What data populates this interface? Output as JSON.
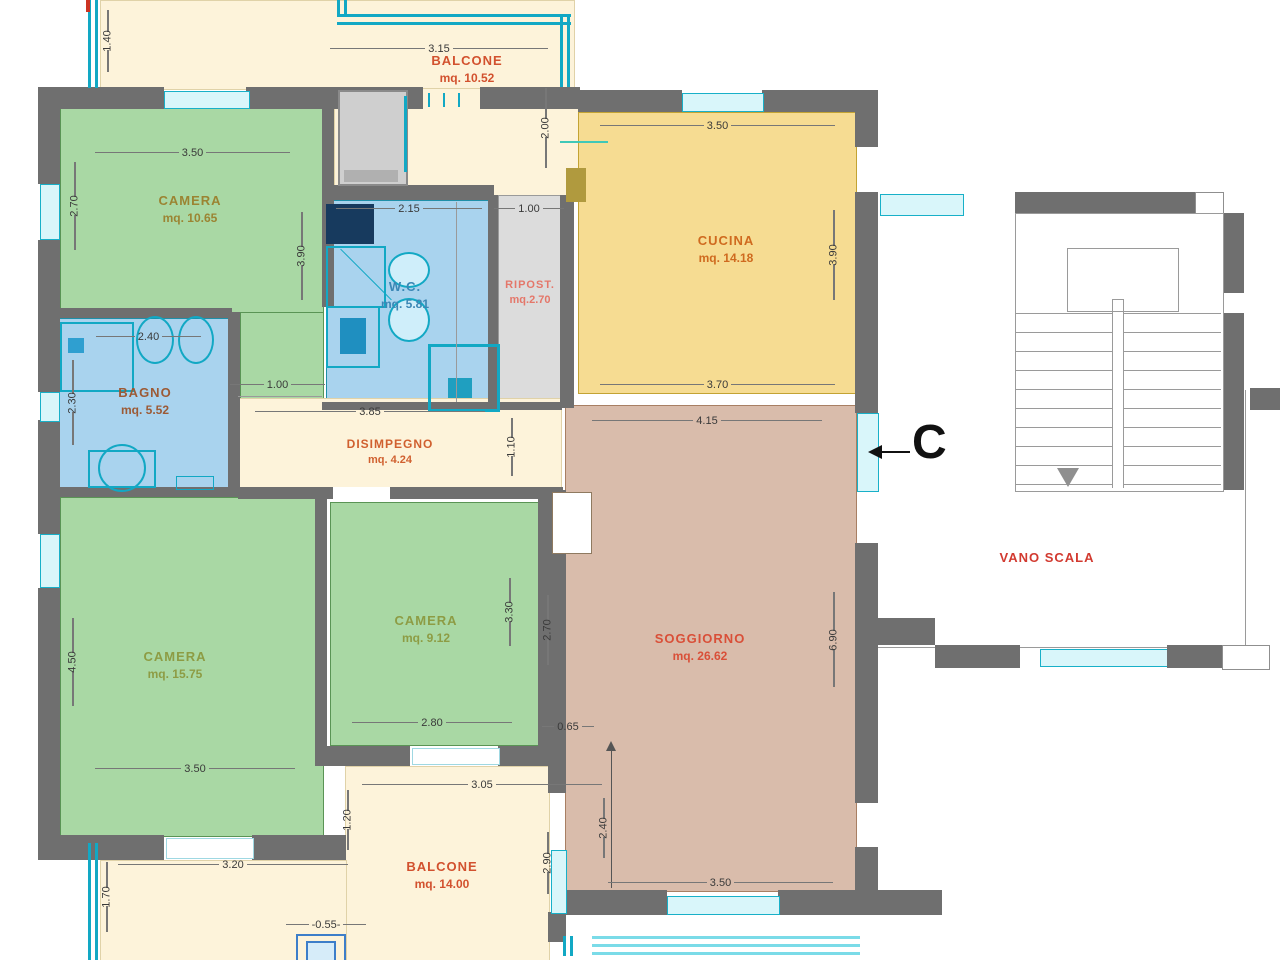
{
  "plan_title": "apartment floor plan",
  "rooms": [
    {
      "id": "camera1",
      "name": "CAMERA",
      "area": "mq. 10.65"
    },
    {
      "id": "bagno",
      "name": "BAGNO",
      "area": "mq. 5.52"
    },
    {
      "id": "wc",
      "name": "W.C.",
      "area": "mq. 5.81"
    },
    {
      "id": "ripostiglio",
      "name": "RIPOST.",
      "area": "mq.2.70"
    },
    {
      "id": "cucina",
      "name": "CUCINA",
      "area": "mq. 14.18"
    },
    {
      "id": "disimpegno",
      "name": "DISIMPEGNO",
      "area": "mq. 4.24"
    },
    {
      "id": "camera2",
      "name": "CAMERA",
      "area": "mq. 15.75"
    },
    {
      "id": "camera3",
      "name": "CAMERA",
      "area": "mq. 9.12"
    },
    {
      "id": "soggiorno",
      "name": "SOGGIORNO",
      "area": "mq. 26.62"
    },
    {
      "id": "balcone1",
      "name": "BALCONE",
      "area": "mq. 10.52"
    },
    {
      "id": "balcone2",
      "name": "BALCONE",
      "area": "mq. 14.00"
    },
    {
      "id": "vano_scala",
      "name": "VANO SCALA"
    }
  ],
  "dims": {
    "rail_top": "1.40",
    "balc1_width": "3.15",
    "balc1_depth": "2.00",
    "cam1_width": "3.50",
    "cam1_left": "2.70",
    "cam1_right": "3.90",
    "cam1_door": "1.00",
    "wc_width": "2.15",
    "rip_width": "1.00",
    "cuc_width": "3.50",
    "cuc_right": "3.90",
    "cuc_bottom": "3.70",
    "bag_width": "2.40",
    "bag_left": "2.30",
    "dis_width": "3.85",
    "dis_height": "1.10",
    "sog_top": "4.15",
    "sog_right": "6.90",
    "sog_left": "2.70",
    "sog_step": "0.65",
    "sog_inner": "2.40",
    "sog_bottom": "3.50",
    "cam3_right": "3.30",
    "cam3_bottom": "2.80",
    "cam2_left": "4.50",
    "cam2_bottom": "3.50",
    "below_width": "3.20",
    "rail_bottom": "1.70",
    "balc2_left": "1.20",
    "balc2_width": "3.05",
    "balc2_right": "2.90",
    "pillar": "-0.55-"
  },
  "section_marker": {
    "label": "C"
  },
  "colors": {
    "camera": "#a9d8a4",
    "bagno_wc": "#a9d3ee",
    "cucina": "#f6dc92",
    "soggiorno": "#d9bcab",
    "balcone": "#fdf3da",
    "ripostiglio": "#dcdcdc",
    "wall": "#6f6f6f",
    "window": "#18b0c8",
    "label_red": "#d2512e",
    "label_olive": "#9b8432",
    "label_green": "#8d9c44",
    "label_blue": "#3b87b5"
  }
}
